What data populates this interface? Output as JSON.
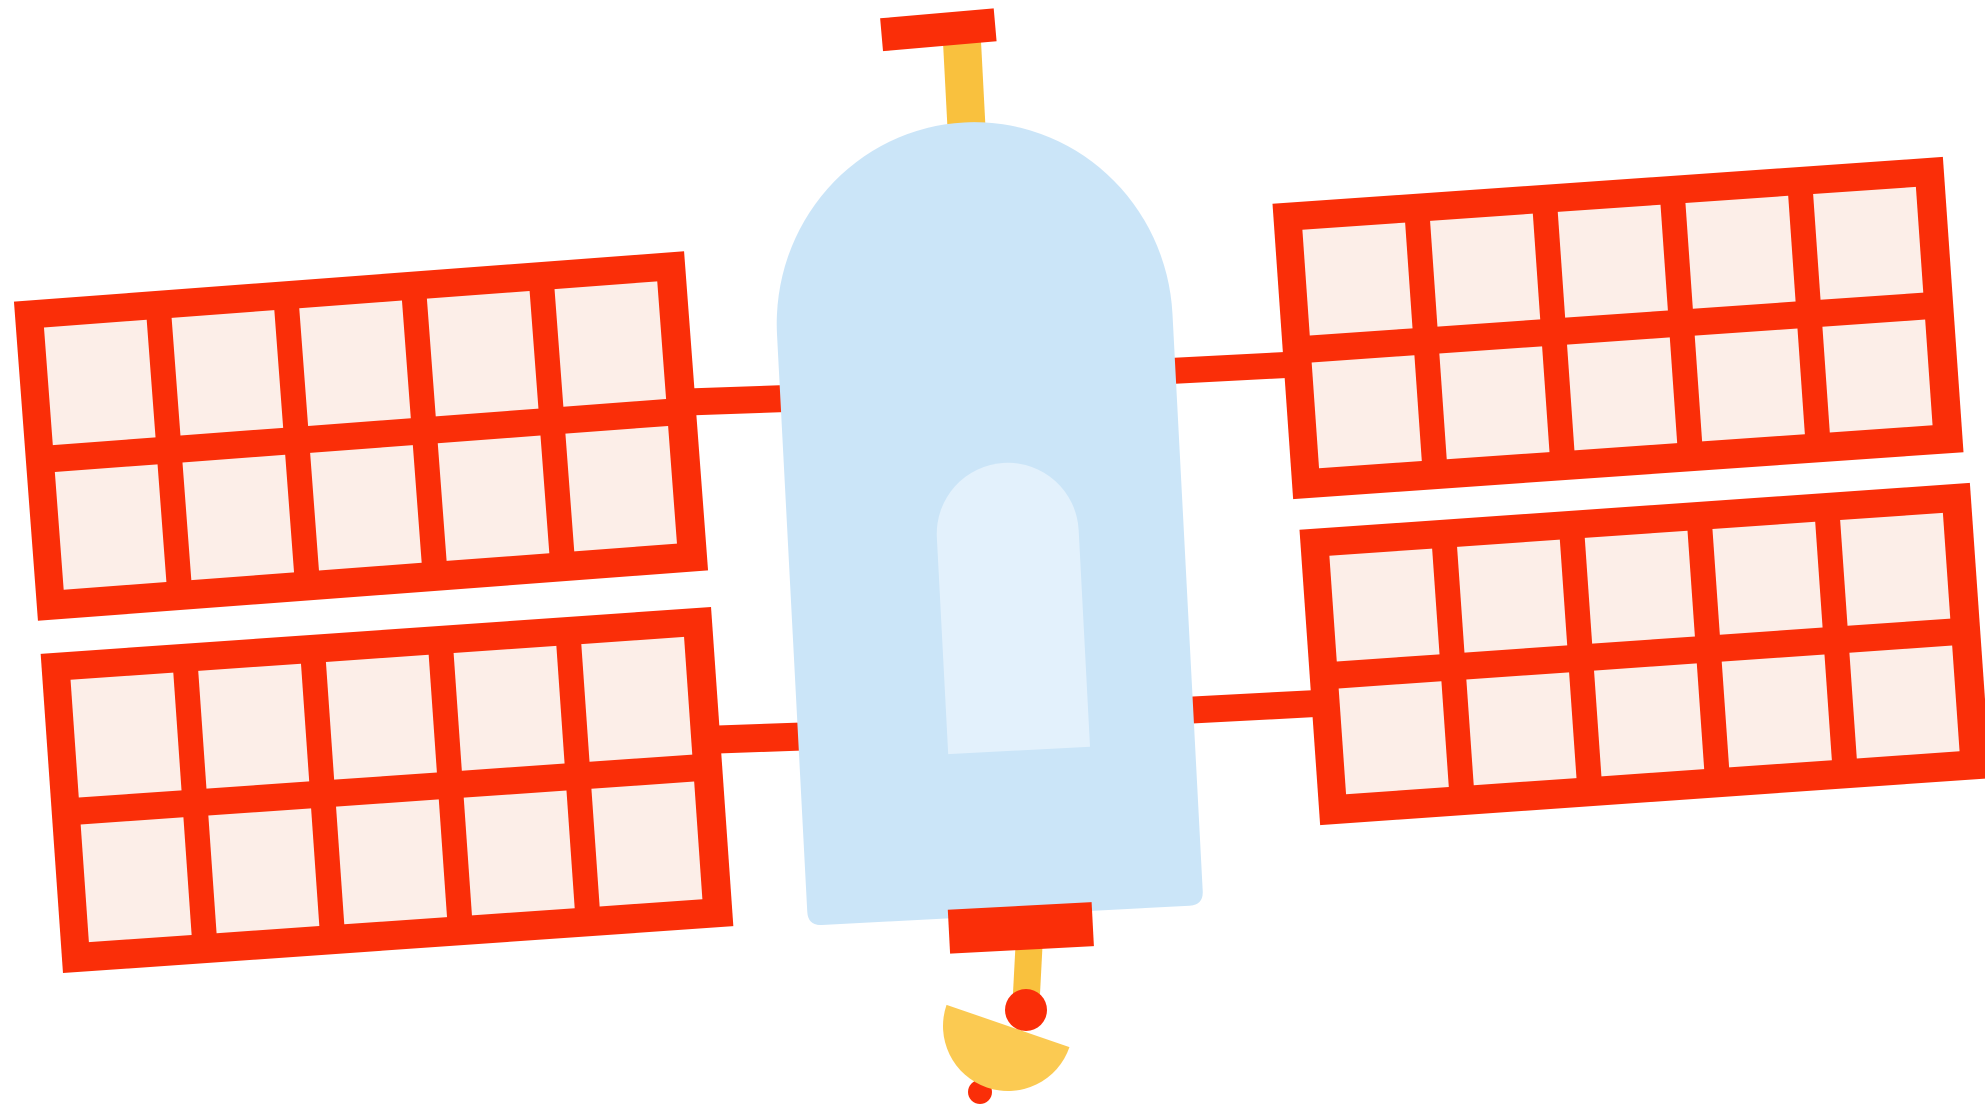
{
  "illustration": {
    "subject": "satellite",
    "background": "#ffffff"
  },
  "colors": {
    "frame_red": "#fa2e08",
    "cell_pink": "#fceee8",
    "body_blue": "#cbe5f8",
    "window_blue": "#e3f1fc",
    "mast_yellow": "#f9c13e",
    "dish_yellow": "#fbca52"
  },
  "panels": {
    "count": 4,
    "columns": 5,
    "rows": 2,
    "cells_per_panel": 10
  }
}
